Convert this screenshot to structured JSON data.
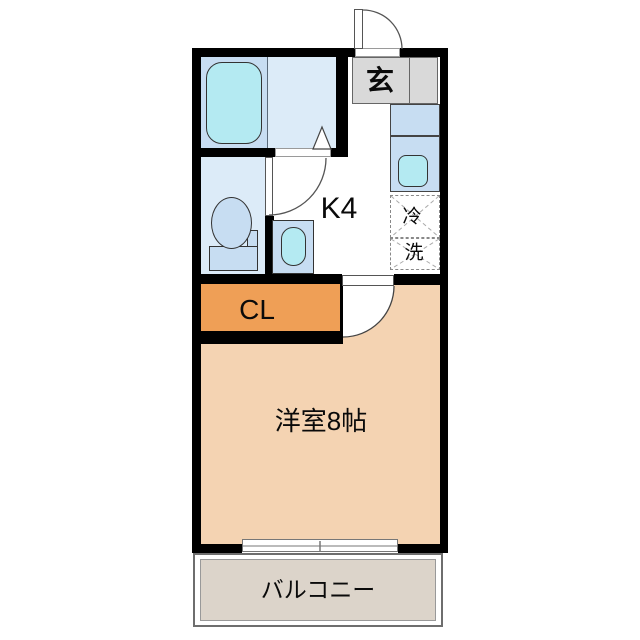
{
  "plan": {
    "type": "apartment-floor-plan",
    "labels": {
      "entrance": "玄",
      "kitchen": "K4",
      "fridge_space": "冷",
      "washer_space": "洗",
      "closet": "CL",
      "main_room": "洋室8帖",
      "balcony": "バルコニー"
    },
    "colors": {
      "wall": "#000000",
      "bath_floor": "#dcebf8",
      "tub_area": "#c7ddf2",
      "fixture_blue": "#c7ddf2",
      "water_cyan": "#b4eaf2",
      "entrance_gray": "#d9d9d9",
      "closet_orange": "#ef9f56",
      "room_peach": "#f4d3b2",
      "balcony_gray": "#dcd4ca",
      "background": "#ffffff"
    }
  }
}
